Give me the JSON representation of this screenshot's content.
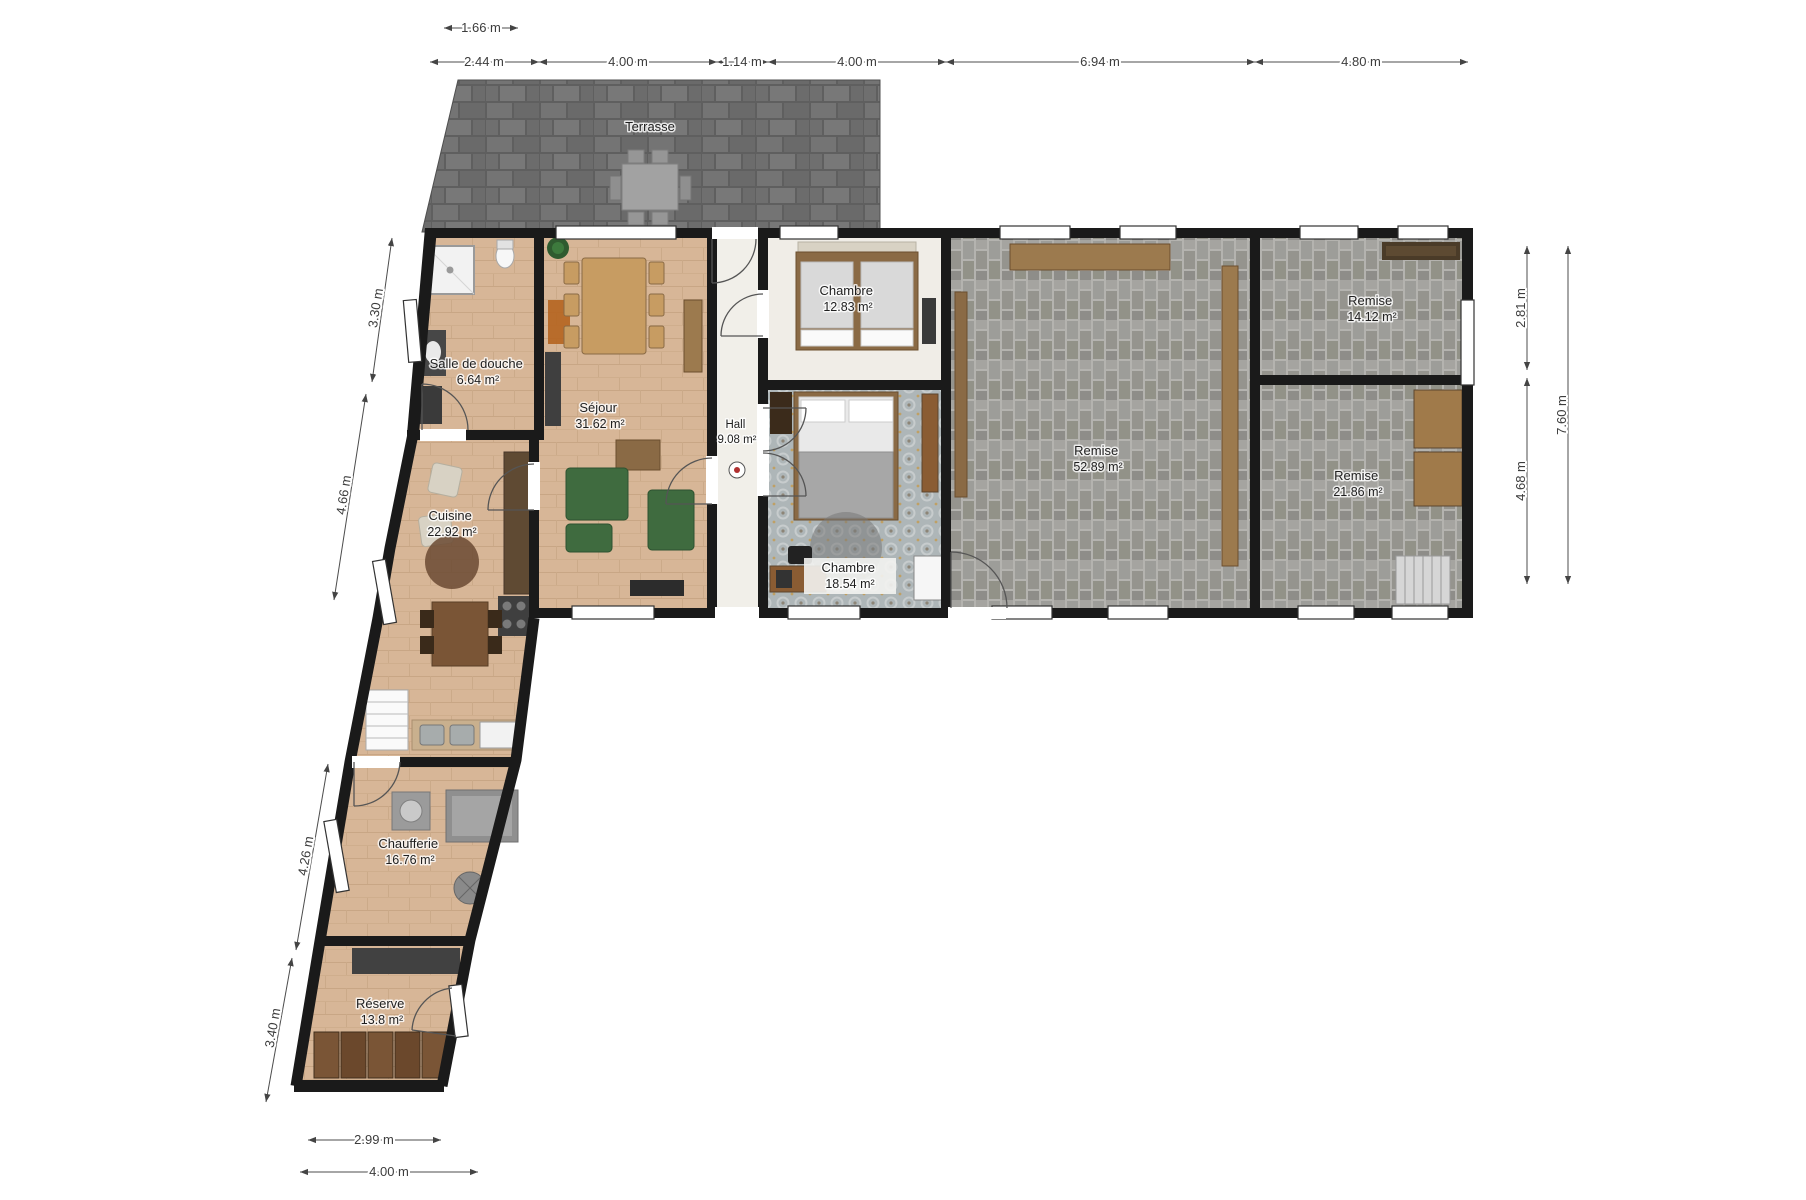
{
  "rooms": [
    {
      "name": "Terrasse",
      "area": ""
    },
    {
      "name": "Salle de douche",
      "area": "6.64 m²"
    },
    {
      "name": "Séjour",
      "area": "31.62 m²"
    },
    {
      "name": "Hall",
      "area": "9.08 m²"
    },
    {
      "name": "Chambre",
      "area": "12.83 m²"
    },
    {
      "name": "Chambre",
      "area": "18.54 m²"
    },
    {
      "name": "Remise",
      "area": "52.89 m²"
    },
    {
      "name": "Remise",
      "area": "14.12 m²"
    },
    {
      "name": "Remise",
      "area": "21.86 m²"
    },
    {
      "name": "Cuisine",
      "area": "22.92 m²"
    },
    {
      "name": "Chaufferie",
      "area": "16.76 m²"
    },
    {
      "name": "Réserve",
      "area": "13.8 m²"
    }
  ],
  "dimensions": {
    "top_upper": "1.66 m",
    "top": [
      "2.44 m",
      "4.00 m",
      "1.14 m",
      "4.00 m",
      "6.94 m",
      "4.80 m"
    ],
    "left": [
      "3.30 m",
      "4.66 m",
      "4.26 m",
      "3.40 m"
    ],
    "right": [
      "2.81 m",
      "4.68 m",
      "7.60 m"
    ],
    "bottom": [
      "2.99 m",
      "4.00 m"
    ]
  },
  "colors": {
    "wall": "#1a1a1a",
    "floor_wood": "#d7b697",
    "floor_hall": "#f1efe9",
    "floor_bedroom1": "#f0ede7",
    "floor_bedroom2": "#aeb6b8",
    "terrace_stone": "#6e6e6e",
    "remise_brick": "#9b9b97",
    "sofa_green": "#3f6b3f",
    "dim_text": "#3c3c3c"
  }
}
